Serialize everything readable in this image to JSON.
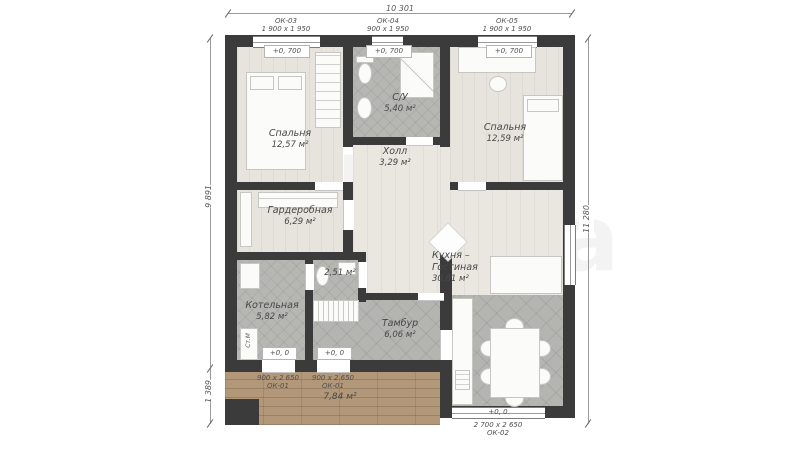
{
  "watermark": {
    "line1": "Два",
    "line2": "этажа"
  },
  "colors": {
    "wall": "#3b3b3b",
    "tile": "#b6b7b3",
    "wood": "#e7e4de",
    "deck": "#b29879"
  },
  "dimensions": {
    "top": "10 301",
    "left_main": "9 891",
    "left_terrace": "1 389",
    "right": "11 280"
  },
  "openings": {
    "ok03": {
      "id": "ОК-03",
      "size": "1 900 х 1 950",
      "elevation": "+0, 700"
    },
    "ok04": {
      "id": "ОК-04",
      "size": "900 х 1 950",
      "elevation": "+0, 700"
    },
    "ok05": {
      "id": "ОК-05",
      "size": "1 900 х 1 950",
      "elevation": "+0, 700"
    },
    "ok01a": {
      "id": "ОК-01",
      "size": "900 х 2 650",
      "elevation": "+0, 0"
    },
    "ok01b": {
      "id": "ОК-01",
      "size": "900 х 2 650",
      "elevation": "+0, 0"
    },
    "ok02": {
      "id": "ОК-02",
      "size": "2 700 х 2 650",
      "elevation": "+0, 0"
    }
  },
  "rooms": {
    "bedroom1": {
      "name": "Спальня",
      "area": "12,57 м²"
    },
    "bathroom": {
      "name": "С/У",
      "area": "5,40 м²"
    },
    "bedroom2": {
      "name": "Спальня",
      "area": "12,59 м²"
    },
    "hall": {
      "name": "Холл",
      "area": "3,29 м²"
    },
    "wardrobe": {
      "name": "Гардеробная",
      "area": "6,29 м²"
    },
    "boiler": {
      "name": "Котельная",
      "area": "5,82 м²"
    },
    "wc": {
      "area": "2,51 м²"
    },
    "tambour": {
      "name": "Тамбур",
      "area": "6,06 м²"
    },
    "kitchen": {
      "name_line1": "Кухня –",
      "name_line2": "Гостиная",
      "area": "30,81 м²"
    },
    "terrace": {
      "area": "7,84 м²"
    }
  },
  "appliances": {
    "washing_machine": "Ст.М"
  }
}
